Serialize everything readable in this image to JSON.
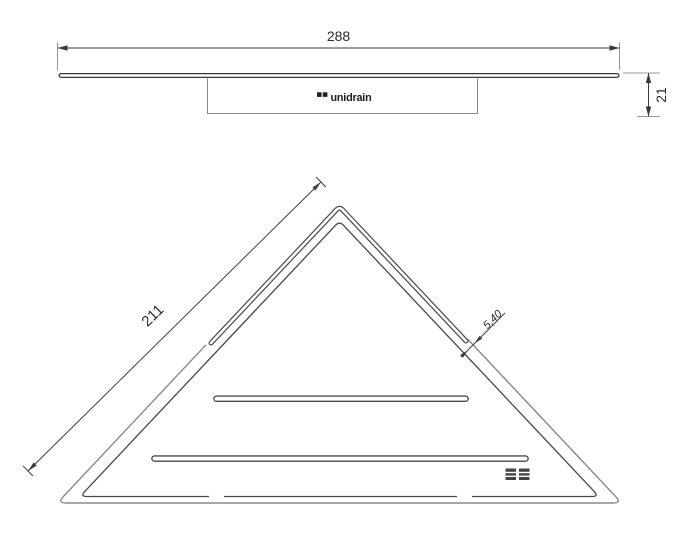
{
  "side_view": {
    "width_dimension": "288",
    "height_dimension": "21",
    "logo_text": "unidrain"
  },
  "front_view": {
    "edge_dimension": "211",
    "slot_width_dimension": "5,40"
  },
  "icons": {
    "logo_mark": "two-filled-squares",
    "corner_mark": "two-striped-squares"
  },
  "colors": {
    "line_dark": "#3a3a3a",
    "line_mid": "#4a4a4a",
    "line_light": "#8a8a8a",
    "text": "#2b2b2b",
    "background": "#ffffff"
  }
}
